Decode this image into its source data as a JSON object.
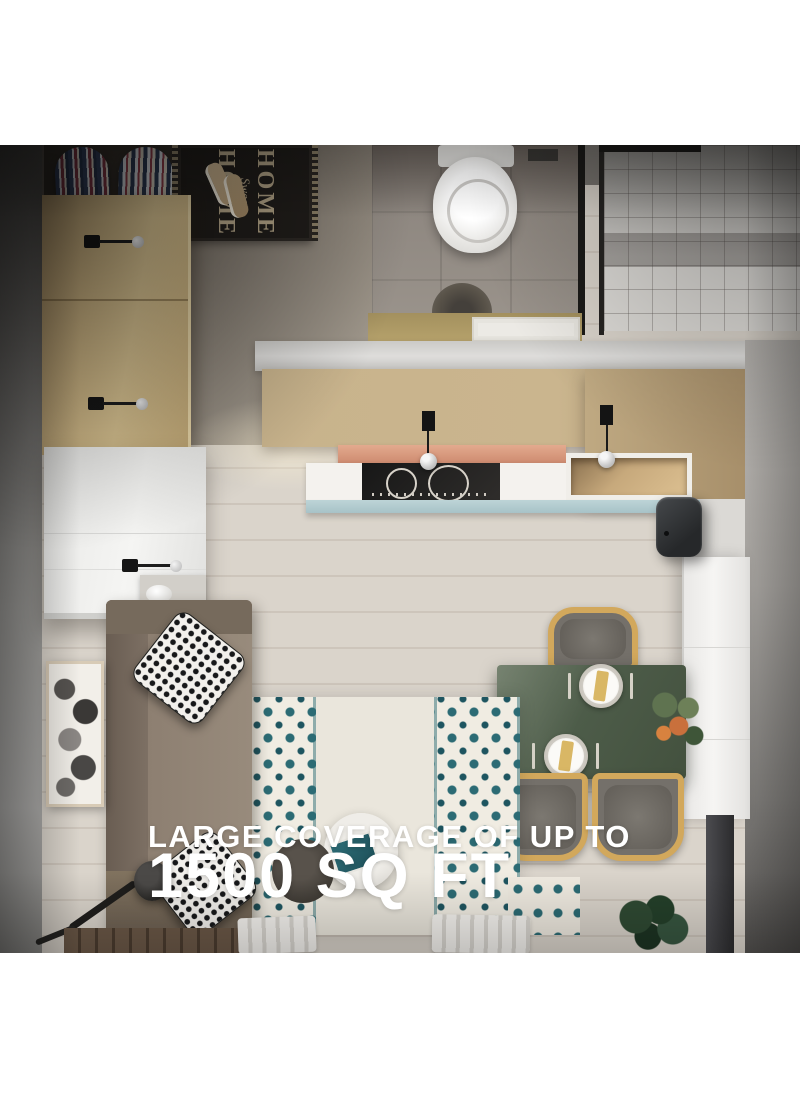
{
  "image": {
    "alt": "Top-down render of a studio apartment with Wi-Fi signal waves radiating from a wall-mounted extender"
  },
  "caption": {
    "line1": "LARGE COVERAGE OF UP TO",
    "line2": "1500 SQ FT"
  },
  "doormat": {
    "word1": "HOME",
    "word2": "Sweet",
    "word3": "HOME"
  },
  "icons": {
    "cube": "cube-outline-icon"
  },
  "colors": {
    "caption_text": "#ffffff",
    "wave_white": "#ffffff",
    "dining_table_green": "#4d5c49",
    "chair_frame_yellow": "#d2a85c",
    "rug_teal": "#2c6b74",
    "device_black": "#26282a",
    "kitchen_shelf_salmon": "#d99c82",
    "backsplash_blue": "#bcd3d6",
    "wardrobe_wood": "#cdb584"
  }
}
